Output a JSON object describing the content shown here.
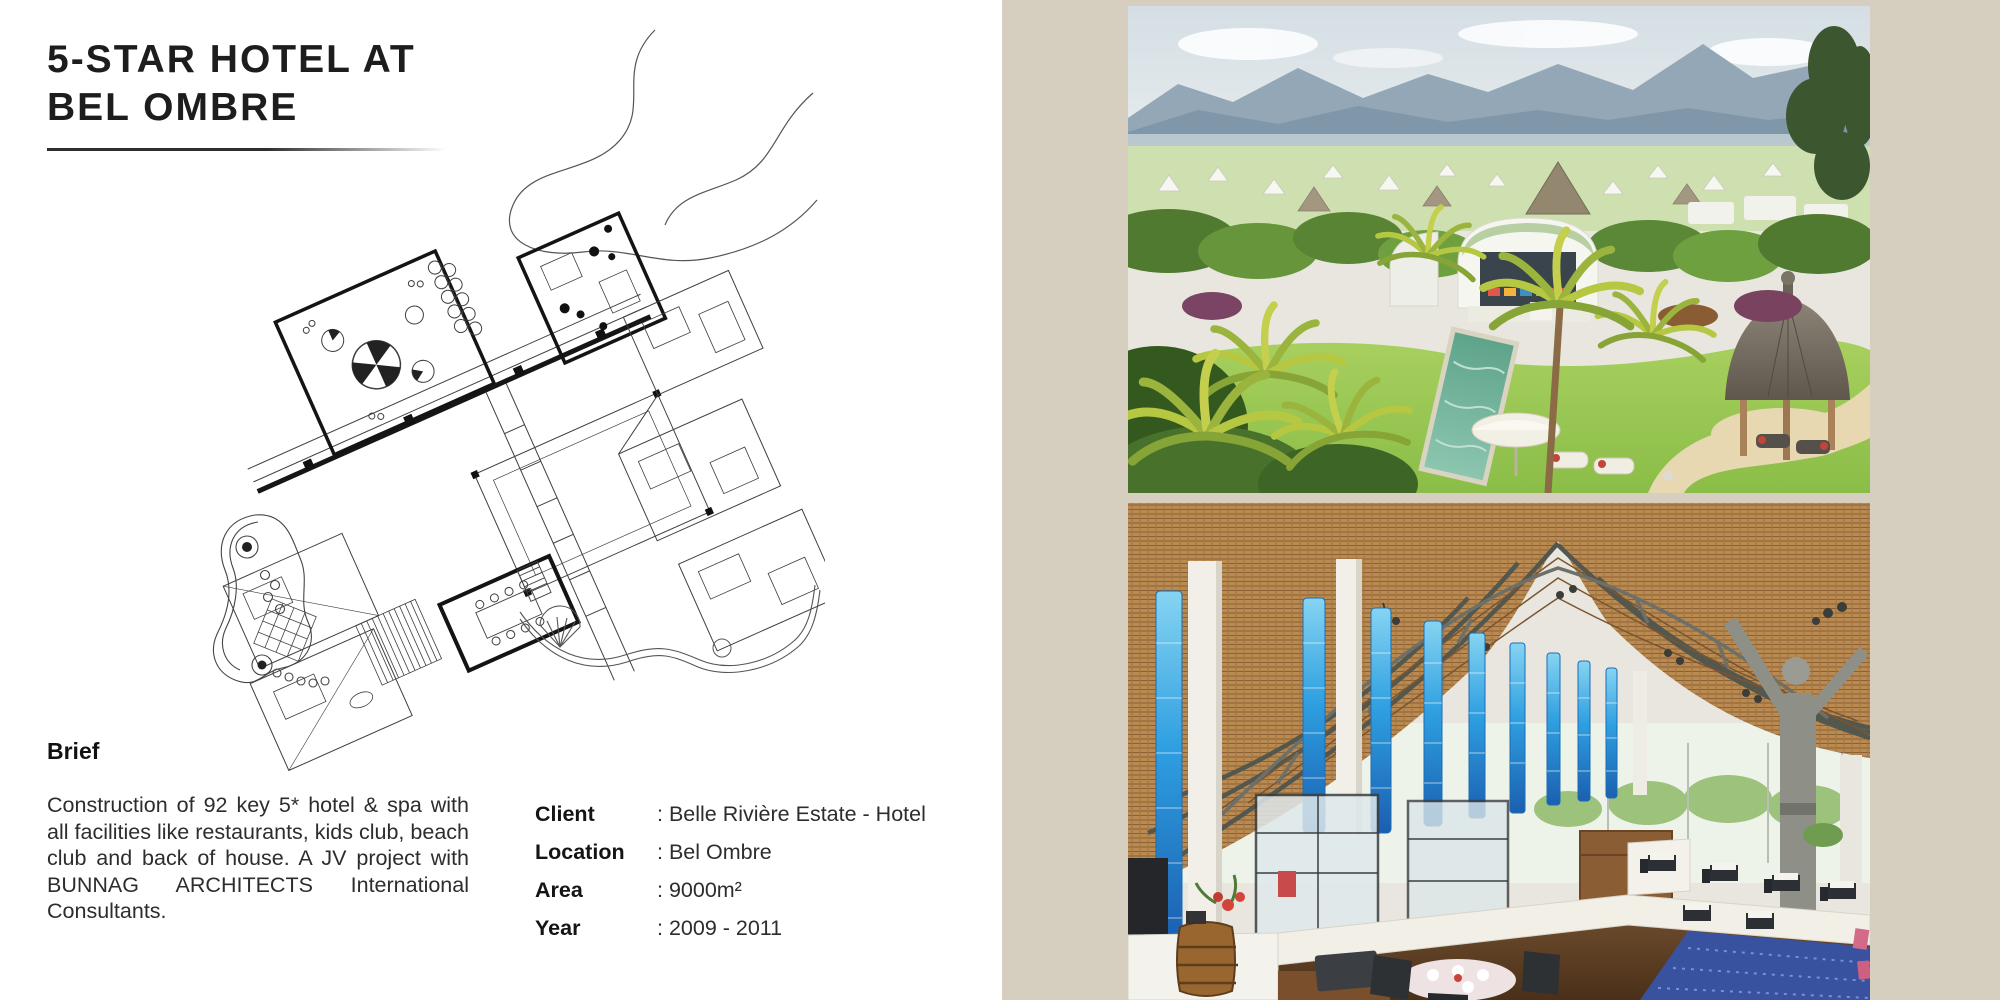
{
  "header": {
    "title_line1": "5-STAR HOTEL AT",
    "title_line2": "BEL OMBRE"
  },
  "brief": {
    "heading": "Brief",
    "body": "Construction of 92 key 5* hotel & spa with all facilities like restaurants, kids club, beach club and back of house. A JV project with BUNNAG ARCHITECTS International Consultants."
  },
  "details": {
    "rows": [
      {
        "label": "Client",
        "value": ": Belle Rivière Estate - Hotel"
      },
      {
        "label": "Location",
        "value": ": Bel Ombre"
      },
      {
        "label": "Area",
        "value": ": 9000m²"
      },
      {
        "label": "Year",
        "value": ": 2009 - 2011"
      }
    ]
  },
  "colors": {
    "panel_beige": "#d6cfbf",
    "plan_ink": "#3f3f3f",
    "accent_blue_columns": "#2e9fe0",
    "pool_teal": "#63a98f",
    "thatch_tan": "#b98a52",
    "lawn_green": "#9cc75a"
  }
}
